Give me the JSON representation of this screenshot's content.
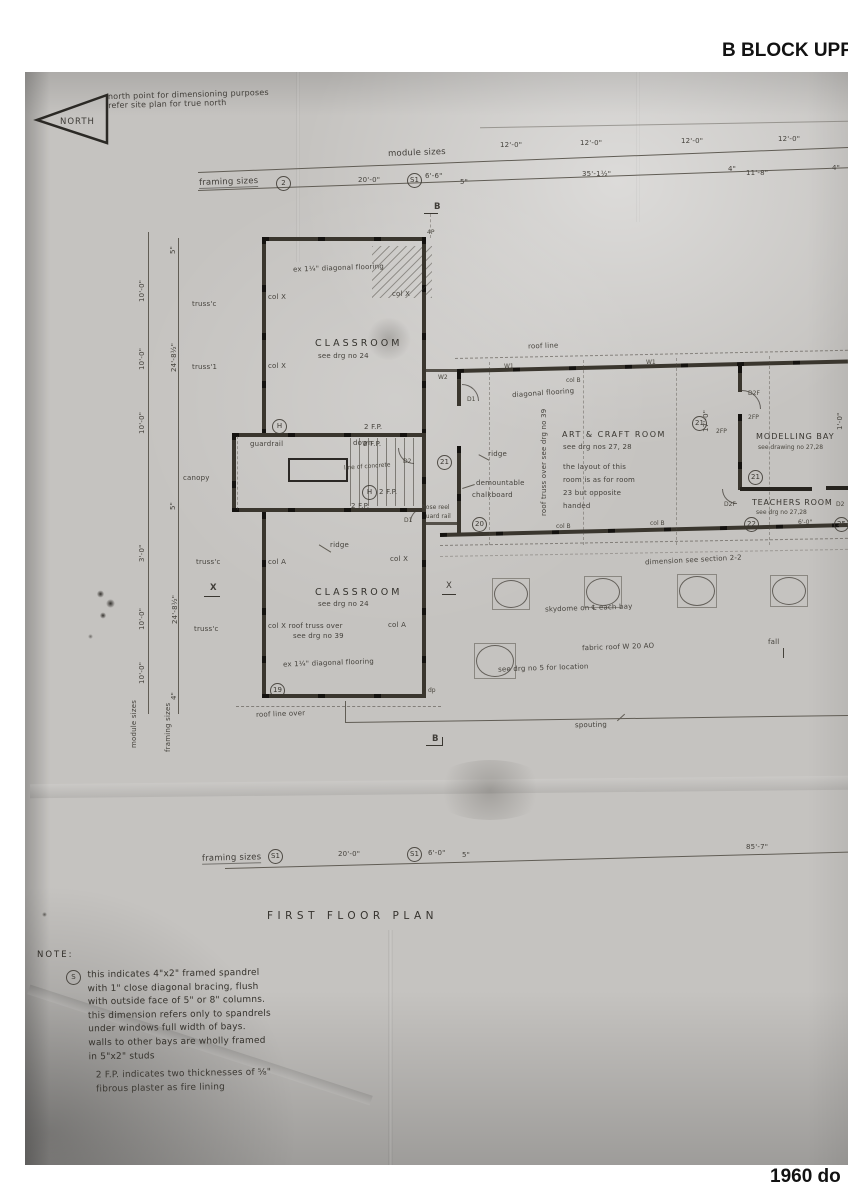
{
  "page": {
    "header_title": "B BLOCK UPPER",
    "footer_caption": "1960 do"
  },
  "north_arrow": {
    "label": "NORTH"
  },
  "north_note": {
    "text": "north point for dimensioning purposes\nrefer site plan for true north"
  },
  "module_line": {
    "label": "module sizes",
    "d1": "12'-0\"",
    "d2": "12'-0\"",
    "d3": "12'-0\"",
    "d4": "12'-0\""
  },
  "framing_line": {
    "label": "framing sizes",
    "ref": "2",
    "s1": "S1",
    "d1": "20'-0\"",
    "d2": "6'-6\"",
    "d3": "5\"",
    "d4": "35'-1½\"",
    "d5": "4\"",
    "d6": "11'-8\"",
    "d7": "4\""
  },
  "section_markers": {
    "b_top": "B",
    "b_bottom": "B",
    "x_left": "X",
    "x_right": "X"
  },
  "classroom_upper": {
    "flooring": "ex 1¼\" diagonal flooring",
    "col_tl": "col X",
    "col_tr": "col X",
    "col_bl": "col X",
    "name": "CLASSROOM",
    "ref": "see drg no 24",
    "tag_4p": "4P"
  },
  "stair": {
    "guardrail": "guardrail",
    "down": "down",
    "fp1": "2 F.P.",
    "fp2": "2 F.P.",
    "fp3": "2 F.P.",
    "fp4": "2 F.P.",
    "concrete": "line of concrete",
    "h1": "H",
    "h2": "H",
    "d2": "D2",
    "num21": "21",
    "canopy": "canopy",
    "hose1": "hose reel",
    "hose2": "guard rail",
    "num20": "20",
    "d1": "D1"
  },
  "classroom_lower": {
    "ridge": "ridge",
    "col_a_l": "col A",
    "col_x_r": "col X",
    "name": "CLASSROOM",
    "ref": "see drg no 24",
    "truss1": "col X   roof truss over",
    "truss2": "see drg no 39",
    "col_a_r": "col A",
    "flooring": "ex 1¼\" diagonal flooring",
    "num19": "19",
    "tag_dp": "dp",
    "roofline_over": "roof line over"
  },
  "art_room": {
    "roofline": "roof line",
    "flooring": "diagonal flooring",
    "ridge": "ridge",
    "truss_vert": "roof truss over see drg no 39",
    "name": "ART & CRAFT ROOM",
    "ref": "see drg nos 27, 28",
    "note": "the layout of this\nroom is as for room\n23 but opposite\nhanded",
    "demount1": "demountable",
    "demount2": "chalkboard",
    "num21": "21",
    "colb_top": "col B",
    "colb1": "col B",
    "colb2": "col B",
    "w1a": "W1",
    "w1b": "W1",
    "w2": "W2",
    "d1": "D1",
    "dim17": "17'-0\"",
    "dim1": "1'-0\""
  },
  "modelling_bay": {
    "name": "MODELLING BAY",
    "ref": "see drawing no 27,28",
    "d2f": "D2F",
    "fp1": "2FP",
    "fp2": "2FP",
    "num21": "21"
  },
  "teachers_room": {
    "name": "TEACHERS ROOM",
    "ref": "see drg no 27,28",
    "d2f": "D2F",
    "d2": "D2",
    "num22": "22",
    "dim": "6'-0\"",
    "num25": "25"
  },
  "roof_area": {
    "dim_note": "dimension see section 2-2",
    "skydome_note": "skydome on ℄ each bay",
    "fabric": "fabric roof W 20 AO",
    "location": "see drg no 5 for location",
    "fall": "fall",
    "spouting": "spouting"
  },
  "left_dims": {
    "module_label": "module sizes",
    "framing_label": "framing sizes",
    "m1": "10'-0\"",
    "m2": "10'-0\"",
    "m3": "10'-0\"",
    "m4": "3'-0\"",
    "m5": "10'-0\"",
    "m6": "10'-0\"",
    "f1": "5\"",
    "f2": "24'-8½\"",
    "f3": "5\"",
    "f4": "24'-8½\"",
    "f5": "4\"",
    "truss1": "truss'c",
    "truss2": "truss'1",
    "truss3": "truss'c",
    "truss4": "truss'c"
  },
  "bottom_line": {
    "label": "framing sizes",
    "s1a": "S1",
    "d1": "20'-0\"",
    "s1b": "S1",
    "d2": "6'-0\"",
    "d3": "5\"",
    "d4": "85'-7\""
  },
  "plan_title": {
    "text": "FIRST  FLOOR  PLAN"
  },
  "note": {
    "heading": "NOTE:",
    "ref": "S",
    "p1": "this indicates 4\"x2\" framed spandrel\nwith 1\" close diagonal bracing, flush\nwith outside face of 5\" or 8\" columns.\nthis dimension refers only to spandrels\nunder windows full width of bays.\nwalls to other bays are wholly framed\nin 5\"x2\" studs",
    "p2": "2 F.P. indicates two thicknesses of ⅝\"\nfibrous plaster as fire lining"
  }
}
